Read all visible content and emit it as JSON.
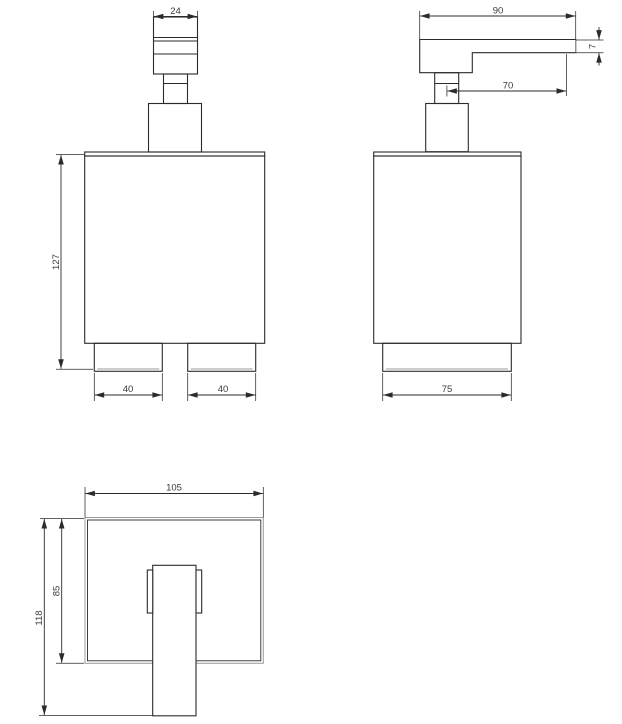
{
  "dimensions": {
    "front": {
      "pump_head_width": "24",
      "height": "127",
      "foot_left_width": "40",
      "foot_right_width": "40"
    },
    "side": {
      "spout_length": "90",
      "spout_tip_height": "7",
      "spout_reach": "70",
      "base_depth": "75"
    },
    "bottom": {
      "body_width": "105",
      "body_depth": "85",
      "overall_depth": "118"
    }
  },
  "colors": {
    "line": "#2b2b2b",
    "shadow_line": "#9b9b9b",
    "dimension_text": "#3a3a3a",
    "background": "#ffffff"
  }
}
